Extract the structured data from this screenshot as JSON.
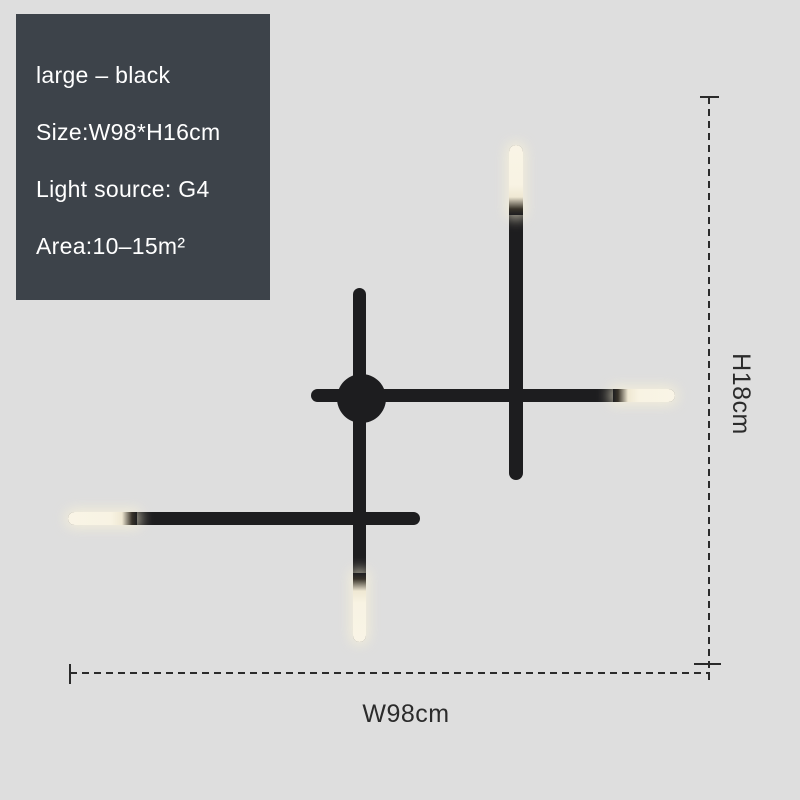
{
  "image_type": "product dimension illustration",
  "colors": {
    "background": "#dedede",
    "panel_background": "#3d434a",
    "panel_text": "#ffffff",
    "rod_black": "#1d1d1f",
    "led_warm_white": "#f8f3e3",
    "annotation_line": "#2b2b2b"
  },
  "spec_panel": {
    "lines": [
      {
        "text": "large – black"
      },
      {
        "text": "Size:W98*H16cm"
      },
      {
        "text": "Light source: G4"
      },
      {
        "text": "Area:10–15m²"
      }
    ]
  },
  "dimensions": {
    "height_label": "H18cm",
    "width_label": "W98cm"
  },
  "product": {
    "description": "black linear cross wall lamp, four rods with warm-white LED tips and round wall canopy"
  }
}
